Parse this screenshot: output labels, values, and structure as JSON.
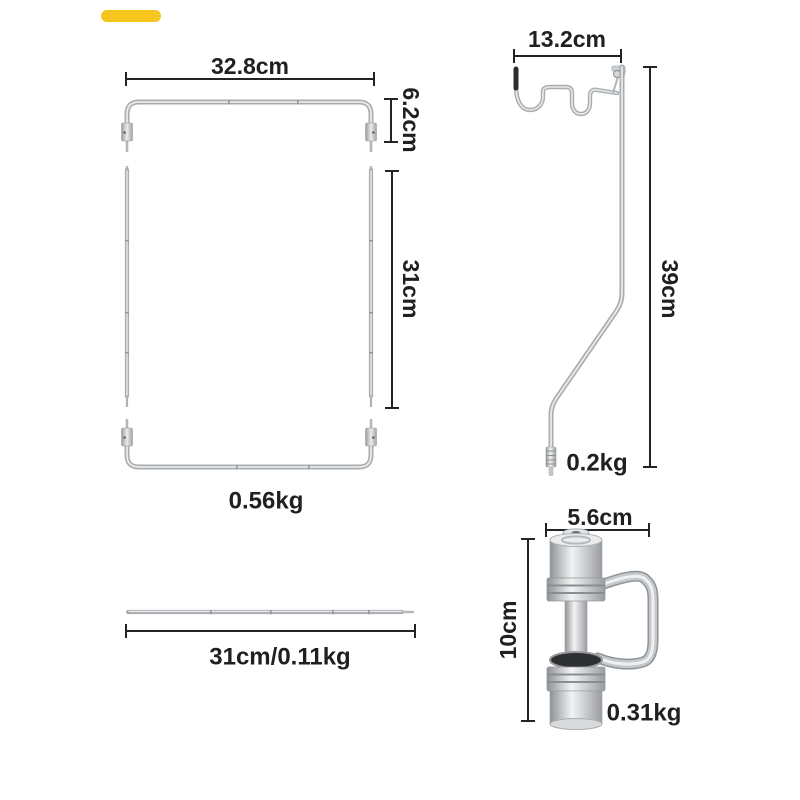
{
  "page": {
    "background": "#ffffff",
    "description_colors": {
      "accent_marker": "#f6c51e",
      "dimension_lines": "#232324",
      "label_text": "#202022",
      "metal_base": "#a9adb0",
      "metal_highlight": "#e8eaeb"
    }
  },
  "marker": {
    "color": "#f6c51e"
  },
  "parts": {
    "frame_top_bar": {
      "width_label": "32.8cm",
      "height_label": "6.2cm"
    },
    "side_rails": {
      "length_label": "31cm"
    },
    "frame_bottom_bar": {
      "weight_label": "0.56kg"
    },
    "lantern_pole": {
      "hook_width_label": "13.2cm",
      "height_label": "39cm",
      "weight_label": "0.2kg"
    },
    "cross_rod": {
      "spec_label": "31cm/0.11kg"
    },
    "pole_clamp": {
      "width_label": "5.6cm",
      "height_label": "10cm",
      "weight_label": "0.31kg"
    }
  }
}
